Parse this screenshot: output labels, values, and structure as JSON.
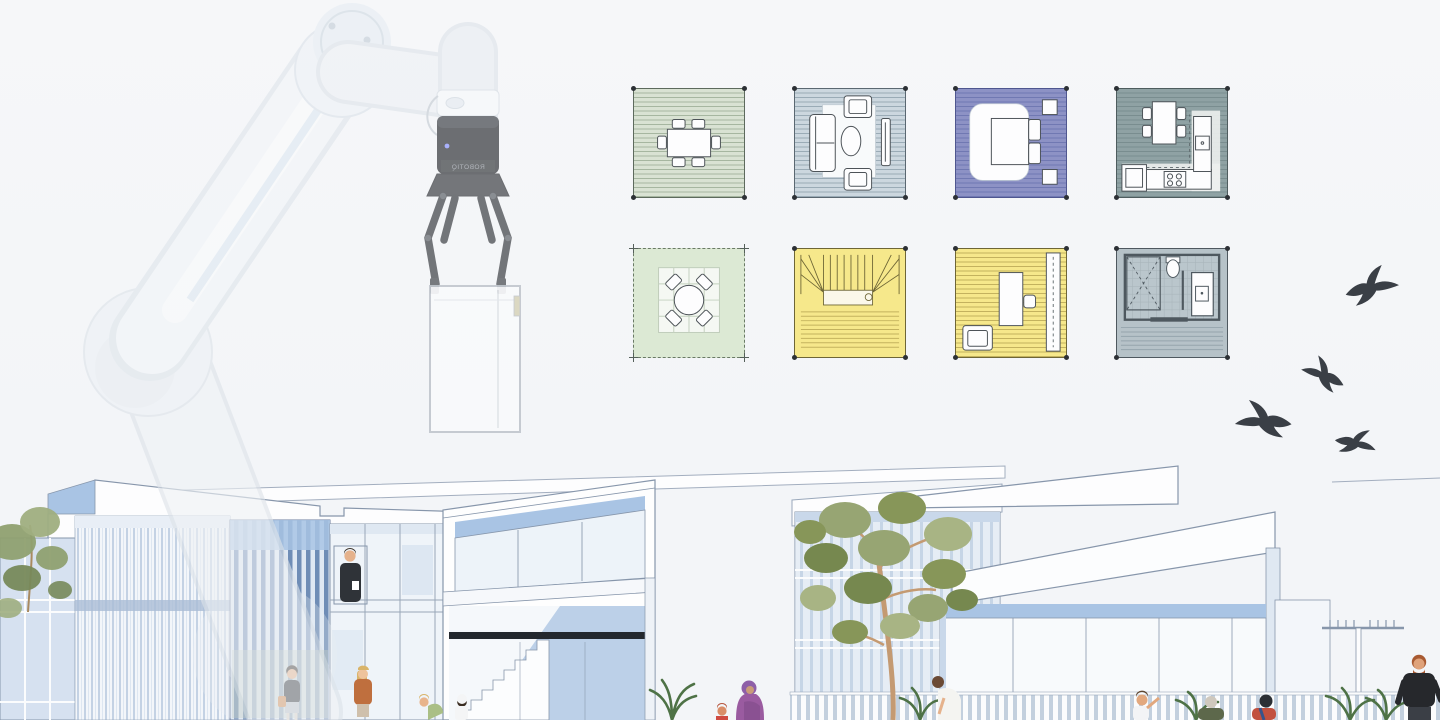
{
  "canvas": {
    "width": 1440,
    "height": 720
  },
  "palette": {
    "background": "#f3f5f8",
    "accent_blue": "#a9c4e4",
    "slat_blue": "#6f8db6",
    "line_blue": "#8796ab",
    "dark_band": "#23282e",
    "bird": "#3a3f46",
    "foliage": "#97a573",
    "foliage_dark": "#76884f",
    "trunk": "#c49a72",
    "fence_gap": "#c3d0de"
  },
  "robot_arm": {
    "description": "translucent collaborative robot arm lowering a white furniture module",
    "gripper_label": "ROBOTIQ",
    "opacity": 0.62
  },
  "floorplan_tiles": {
    "rows": 2,
    "cols": 4,
    "tiles": [
      {
        "room": "dining-room",
        "floor": "#d9e2d3",
        "line": "#a6b6a0",
        "border": "#5d6a5d"
      },
      {
        "room": "living-room",
        "floor": "#ccd7df",
        "line": "#9aabb6",
        "border": "#5a6771"
      },
      {
        "room": "bedroom",
        "floor": "#8d92c5",
        "line": "#7078b2",
        "border": "#4f568f"
      },
      {
        "room": "kitchen",
        "floor": "#8fa2a4",
        "line": "#798d8f",
        "border": "#4e5c5e"
      },
      {
        "room": "patio",
        "floor": "#dce9d4",
        "line": "#c4d1bf",
        "border": "#5d6a5d"
      },
      {
        "room": "staircase",
        "floor": "#f6e88b",
        "line": "#c3b25e",
        "border": "#6e6636"
      },
      {
        "room": "study-bedroom",
        "floor": "#f6e88b",
        "line": "#c3b25e",
        "border": "#6e6636"
      },
      {
        "room": "bathroom",
        "floor": "#b6c2c8",
        "line": "#95a4ac",
        "border": "#4e585f"
      }
    ]
  },
  "birds": [
    {
      "left": 1342,
      "top": 264,
      "width": 60,
      "height": 46,
      "rotate": -6,
      "flip": false
    },
    {
      "left": 1298,
      "top": 348,
      "width": 50,
      "height": 54,
      "rotate": 16,
      "flip": true
    },
    {
      "left": 1230,
      "top": 398,
      "width": 66,
      "height": 46,
      "rotate": -4,
      "flip": true
    },
    {
      "left": 1326,
      "top": 426,
      "width": 60,
      "height": 34,
      "rotate": 18,
      "flip": false
    }
  ],
  "scene": {
    "buildings": [
      "left-apartment-block",
      "middle-townhouse",
      "right-townhouse"
    ],
    "figures": [
      {
        "id": "man-in-window",
        "top": "#2f3338"
      },
      {
        "id": "woman-black-top",
        "top": "#23262b"
      },
      {
        "id": "woman-rust-jacket",
        "top": "#bf6f3e"
      },
      {
        "id": "girl-green",
        "top": "#aabf85"
      },
      {
        "id": "girl-white-cap",
        "top": "#f4f5f6"
      },
      {
        "id": "woman-purple-hijab",
        "top": "#9a5ba0"
      },
      {
        "id": "toddler-red",
        "top": "#cf4a41"
      },
      {
        "id": "woman-white-top",
        "top": "#f4f4f1"
      },
      {
        "id": "child-white",
        "top": "#f3f4f6"
      },
      {
        "id": "elderly-olive-coat",
        "top": "#5d684b"
      },
      {
        "id": "woman-red-scarf",
        "top": "#c2513f"
      },
      {
        "id": "man-black-tshirt",
        "top": "#26282c"
      }
    ]
  }
}
